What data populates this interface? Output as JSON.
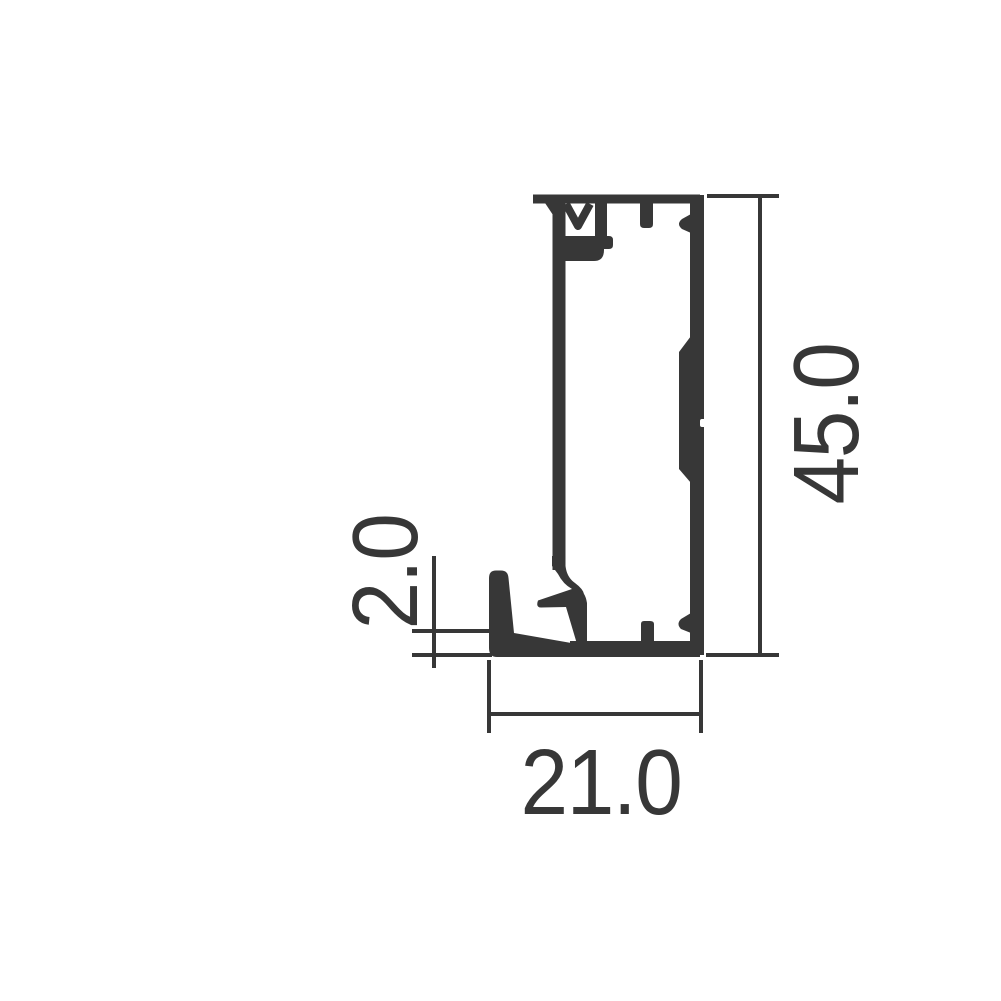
{
  "drawing": {
    "title": "aluminium-profile-cross-section",
    "colors": {
      "background": "#ffffff",
      "line": "#373737"
    },
    "dimensions": {
      "height": {
        "value": "45.0",
        "orientation": "vertical",
        "position": "right"
      },
      "bottom_wall_thickness": {
        "value": "2.0",
        "orientation": "vertical",
        "position": "left"
      },
      "width": {
        "value": "21.0",
        "orientation": "horizontal",
        "position": "bottom"
      }
    }
  }
}
